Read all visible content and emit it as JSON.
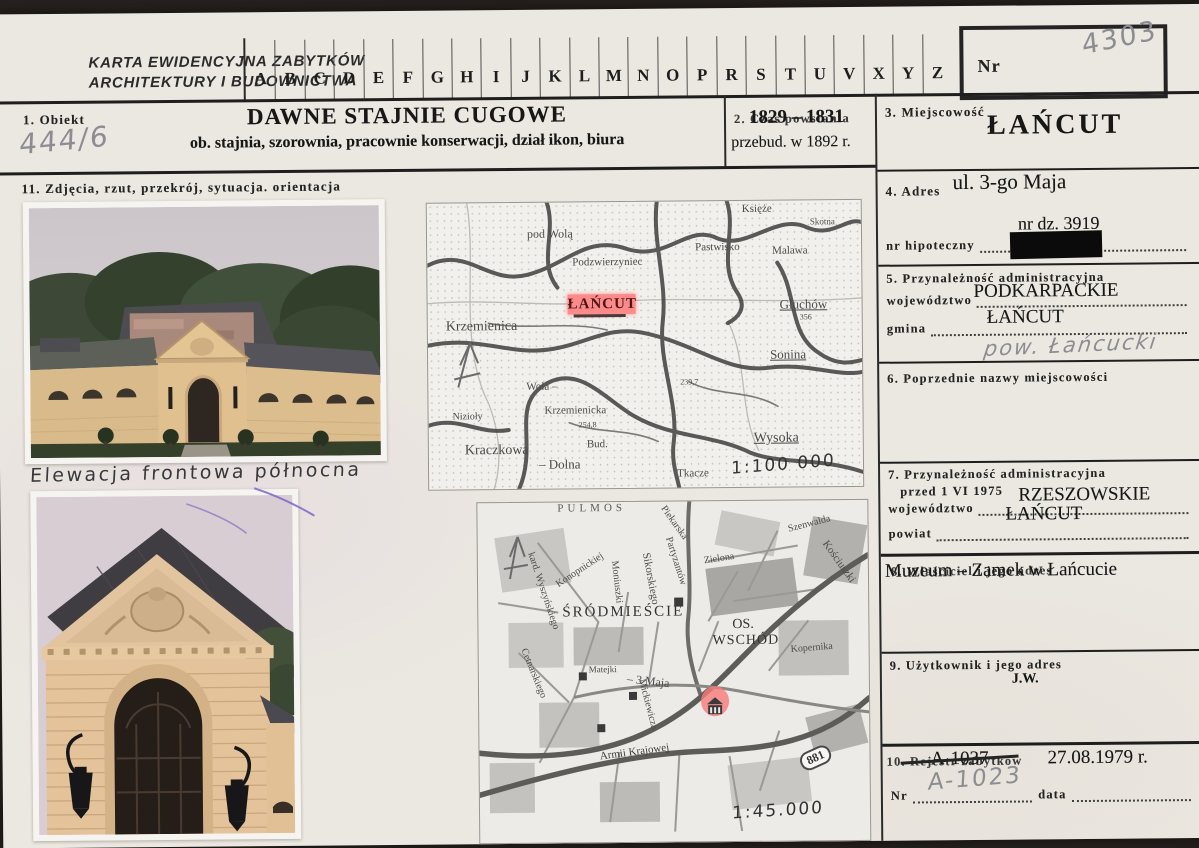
{
  "header": {
    "org_line1": "KARTA EWIDENCYJNA ZABYTKÓW",
    "org_line2": "ARCHITEKTURY I BUDOWNICTWA",
    "alphabet": [
      "A",
      "B",
      "C",
      "D",
      "E",
      "F",
      "G",
      "H",
      "I",
      "J",
      "K",
      "L",
      "M",
      "N",
      "O",
      "P",
      "R",
      "S",
      "T",
      "U",
      "V",
      "X",
      "Y",
      "Z"
    ],
    "nr_label": "Nr",
    "nr_value": "4303"
  },
  "object": {
    "label": "1. Obiekt",
    "inventory_no": "444/6",
    "title": "DAWNE STAJNIE CUGOWE",
    "subtitle": "ob. stajnia, szorownia, pracownie konserwacji, dział ikon, biura"
  },
  "time": {
    "label": "2. Czas powstania",
    "value": "1829 – 1831",
    "note": "przebud. w 1892 r."
  },
  "place": {
    "label": "3. Miejscowość",
    "value": "ŁAŃCUT"
  },
  "address": {
    "label": "4. Adres",
    "street": "ul. 3-go Maja",
    "plot": "nr dz. 3919",
    "mortgage_label": "nr hipoteczny"
  },
  "admin": {
    "label": "5. Przynależność administracyjna",
    "voivodeship_label": "województwo",
    "voivodeship": "PODKARPACKIE",
    "commune_label": "gmina",
    "commune": "ŁAŃCUT",
    "handwritten": "pow. Łańcucki"
  },
  "former_names": {
    "label": "6. Poprzednie nazwy miejscowości"
  },
  "admin_before": {
    "label_line1": "7. Przynależność administracyjna",
    "label_line2": "przed 1 VI 1975",
    "voivodeship_label": "województwo",
    "voivodeship": "RZESZOWSKIE",
    "district_label": "powiat",
    "district": "ŁAŃCUT"
  },
  "owner": {
    "label": "8. Właściciel i jego adres",
    "value": "Muzeum – Zamek w Łańcucie"
  },
  "user": {
    "label": "9. Użytkownik i jego adres",
    "value": "j.w."
  },
  "register": {
    "label": "10. Rejestr zabytków",
    "old_no": "A-1037",
    "date_value": "27.08.1979 r.",
    "nr_label": "Nr",
    "handwritten_no": "A-1023",
    "data_label": "data"
  },
  "media": {
    "label": "11. Zdjęcia, rzut, przekrój, sytuacja. orientacja",
    "photo1_caption": "Elewacja frontowa północna",
    "map1": {
      "scale": "1:100 000",
      "town": "ŁAŃCUT",
      "places": [
        "Księże",
        "pod Wolą",
        "Skotna",
        "Pastwisko",
        "Malawa",
        "Podzwierzyniec",
        "Krzemienica",
        "Głuchów",
        "Sonina",
        "Wola –",
        "Krzemienicka",
        "Nizioły",
        "Kraczkowa",
        "– Dolna",
        "Bud.",
        "Wysoka",
        "Tkacze"
      ],
      "elevations": [
        "356",
        "239,7",
        "254,8"
      ]
    },
    "map2": {
      "scale": "1:45.000",
      "area_top": "PULMOS",
      "district1": "ŚRÓDMIEŚCIE",
      "district2a": "OS.",
      "district2b": "WSCHÓD",
      "road_badge": "881",
      "streets": [
        "kard. Wyszyńskiego",
        "Konopnickiej",
        "Moniuszki",
        "Sikorskiego",
        "Piekarska",
        "Partyzantów",
        "Zielona",
        "Szenwalda",
        "Kościuszki",
        "Kopernika",
        "Cetnarskiego",
        "– 3 Maja",
        "Matejki",
        "Mickiewicza",
        "Armii Krajowej"
      ]
    }
  }
}
